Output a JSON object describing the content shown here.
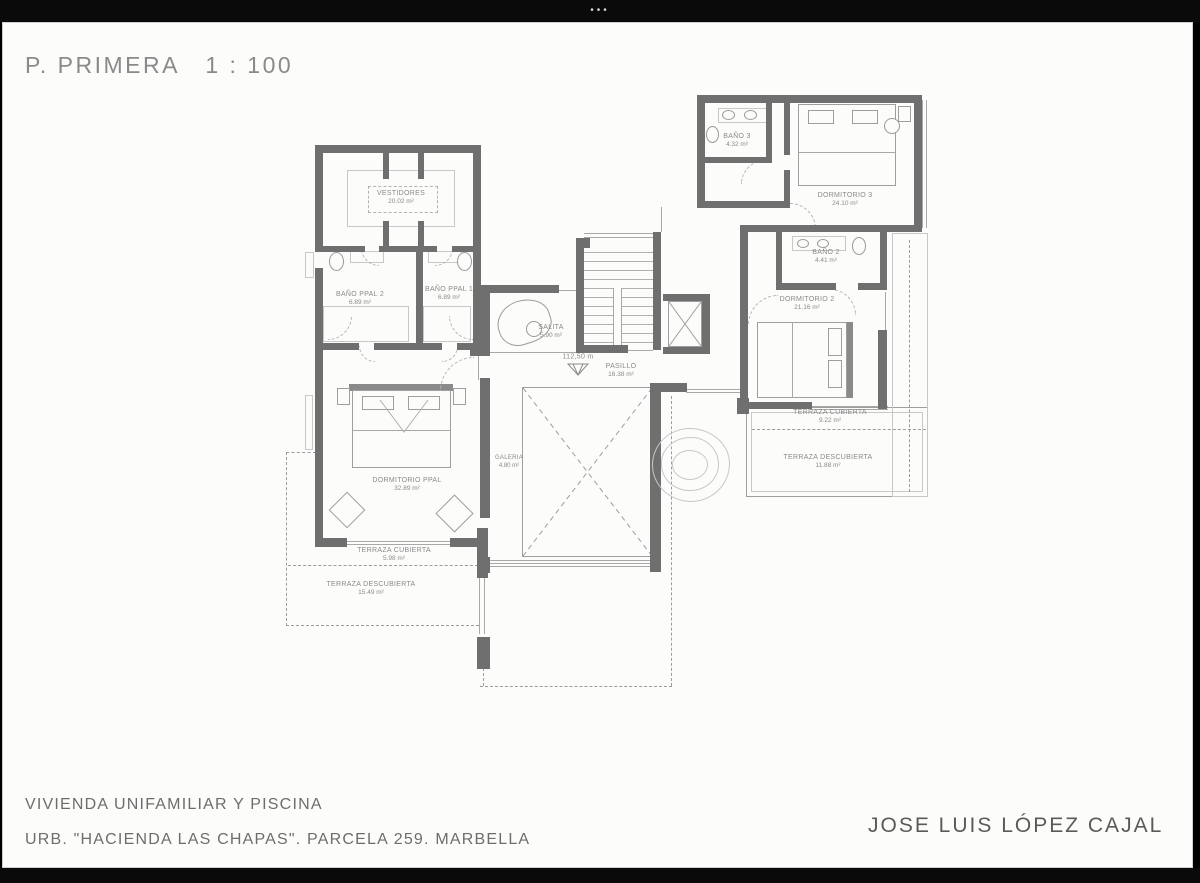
{
  "viewer": {
    "menu_dots": "•••"
  },
  "title": "P. PRIMERA   1 : 100",
  "footer": {
    "line1": "VIVIENDA UNIFAMILIAR Y PISCINA",
    "line2": "URB. \"HACIENDA LAS CHAPAS\". PARCELA 259. MARBELLA",
    "architect": "JOSE LUIS LÓPEZ CAJAL"
  },
  "plan": {
    "level_marker": "112,50 m",
    "rooms": [
      {
        "name": "BAÑO 3",
        "area": "4.32 m²"
      },
      {
        "name": "DORMITORIO 3",
        "area": "24.10 m²"
      },
      {
        "name": "BAÑO 2",
        "area": "4.41 m²"
      },
      {
        "name": "DORMITORIO 2",
        "area": "21.16 m²"
      },
      {
        "name": "TERRAZA CUBIERTA",
        "area": "9.22 m²"
      },
      {
        "name": "TERRAZA DESCUBIERTA",
        "area": "11.88 m²"
      },
      {
        "name": "VESTIDORES",
        "area": "20.02 m²"
      },
      {
        "name": "BAÑO PPAL 2",
        "area": "6.89 m²"
      },
      {
        "name": "BAÑO PPAL 1",
        "area": "6.89 m²"
      },
      {
        "name": "SALITA",
        "area": "5.90 m²"
      },
      {
        "name": "PASILLO",
        "area": "16.38 m²"
      },
      {
        "name": "DORMITORIO PPAL",
        "area": "32.89 m²"
      },
      {
        "name": "GALERIA",
        "area": "4.80 m²"
      },
      {
        "name": "TERRAZA CUBIERTA",
        "area": "5.98 m²"
      },
      {
        "name": "TERRAZA DESCUBIERTA",
        "area": "15.49 m²"
      }
    ]
  },
  "colors": {
    "frame": "#0a0a0a",
    "paper": "#fcfcfb",
    "wall": "#6f6f6f",
    "thin_line": "#a8a8a8",
    "label_text": "#8a8a8a"
  }
}
